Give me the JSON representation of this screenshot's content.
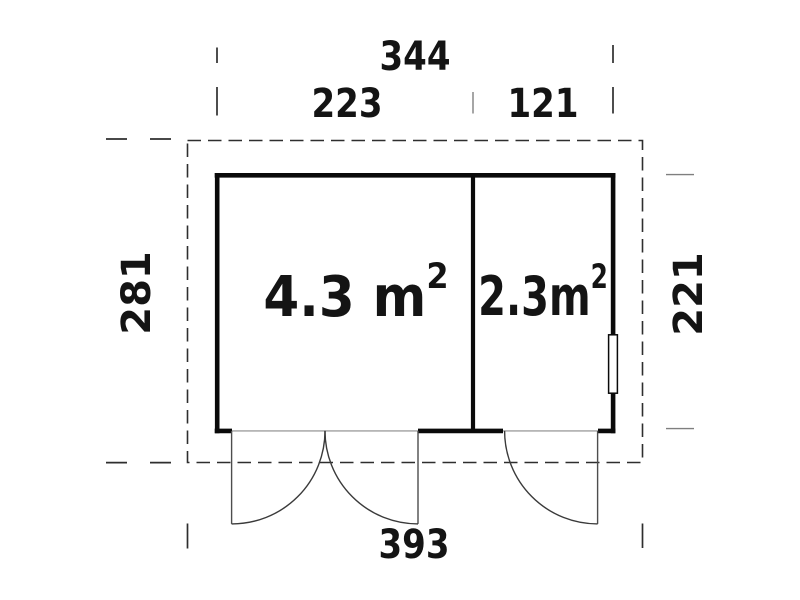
{
  "plan": {
    "type": "shed-floor-plan",
    "dimensions": {
      "total_width": "344",
      "left_section_width": "223",
      "right_section_width": "121",
      "left_depth": "281",
      "right_depth": "221",
      "base_width": "393"
    },
    "rooms": [
      {
        "area": "4.3 m",
        "sup": "2"
      },
      {
        "area": "2.3m",
        "sup": "2"
      }
    ],
    "colors": {
      "wall": "#0a0a0a",
      "dashed_line": "#2e2e2e",
      "gray_line": "#7f7f7f",
      "text": "#141414",
      "background": "#ffffff"
    }
  }
}
